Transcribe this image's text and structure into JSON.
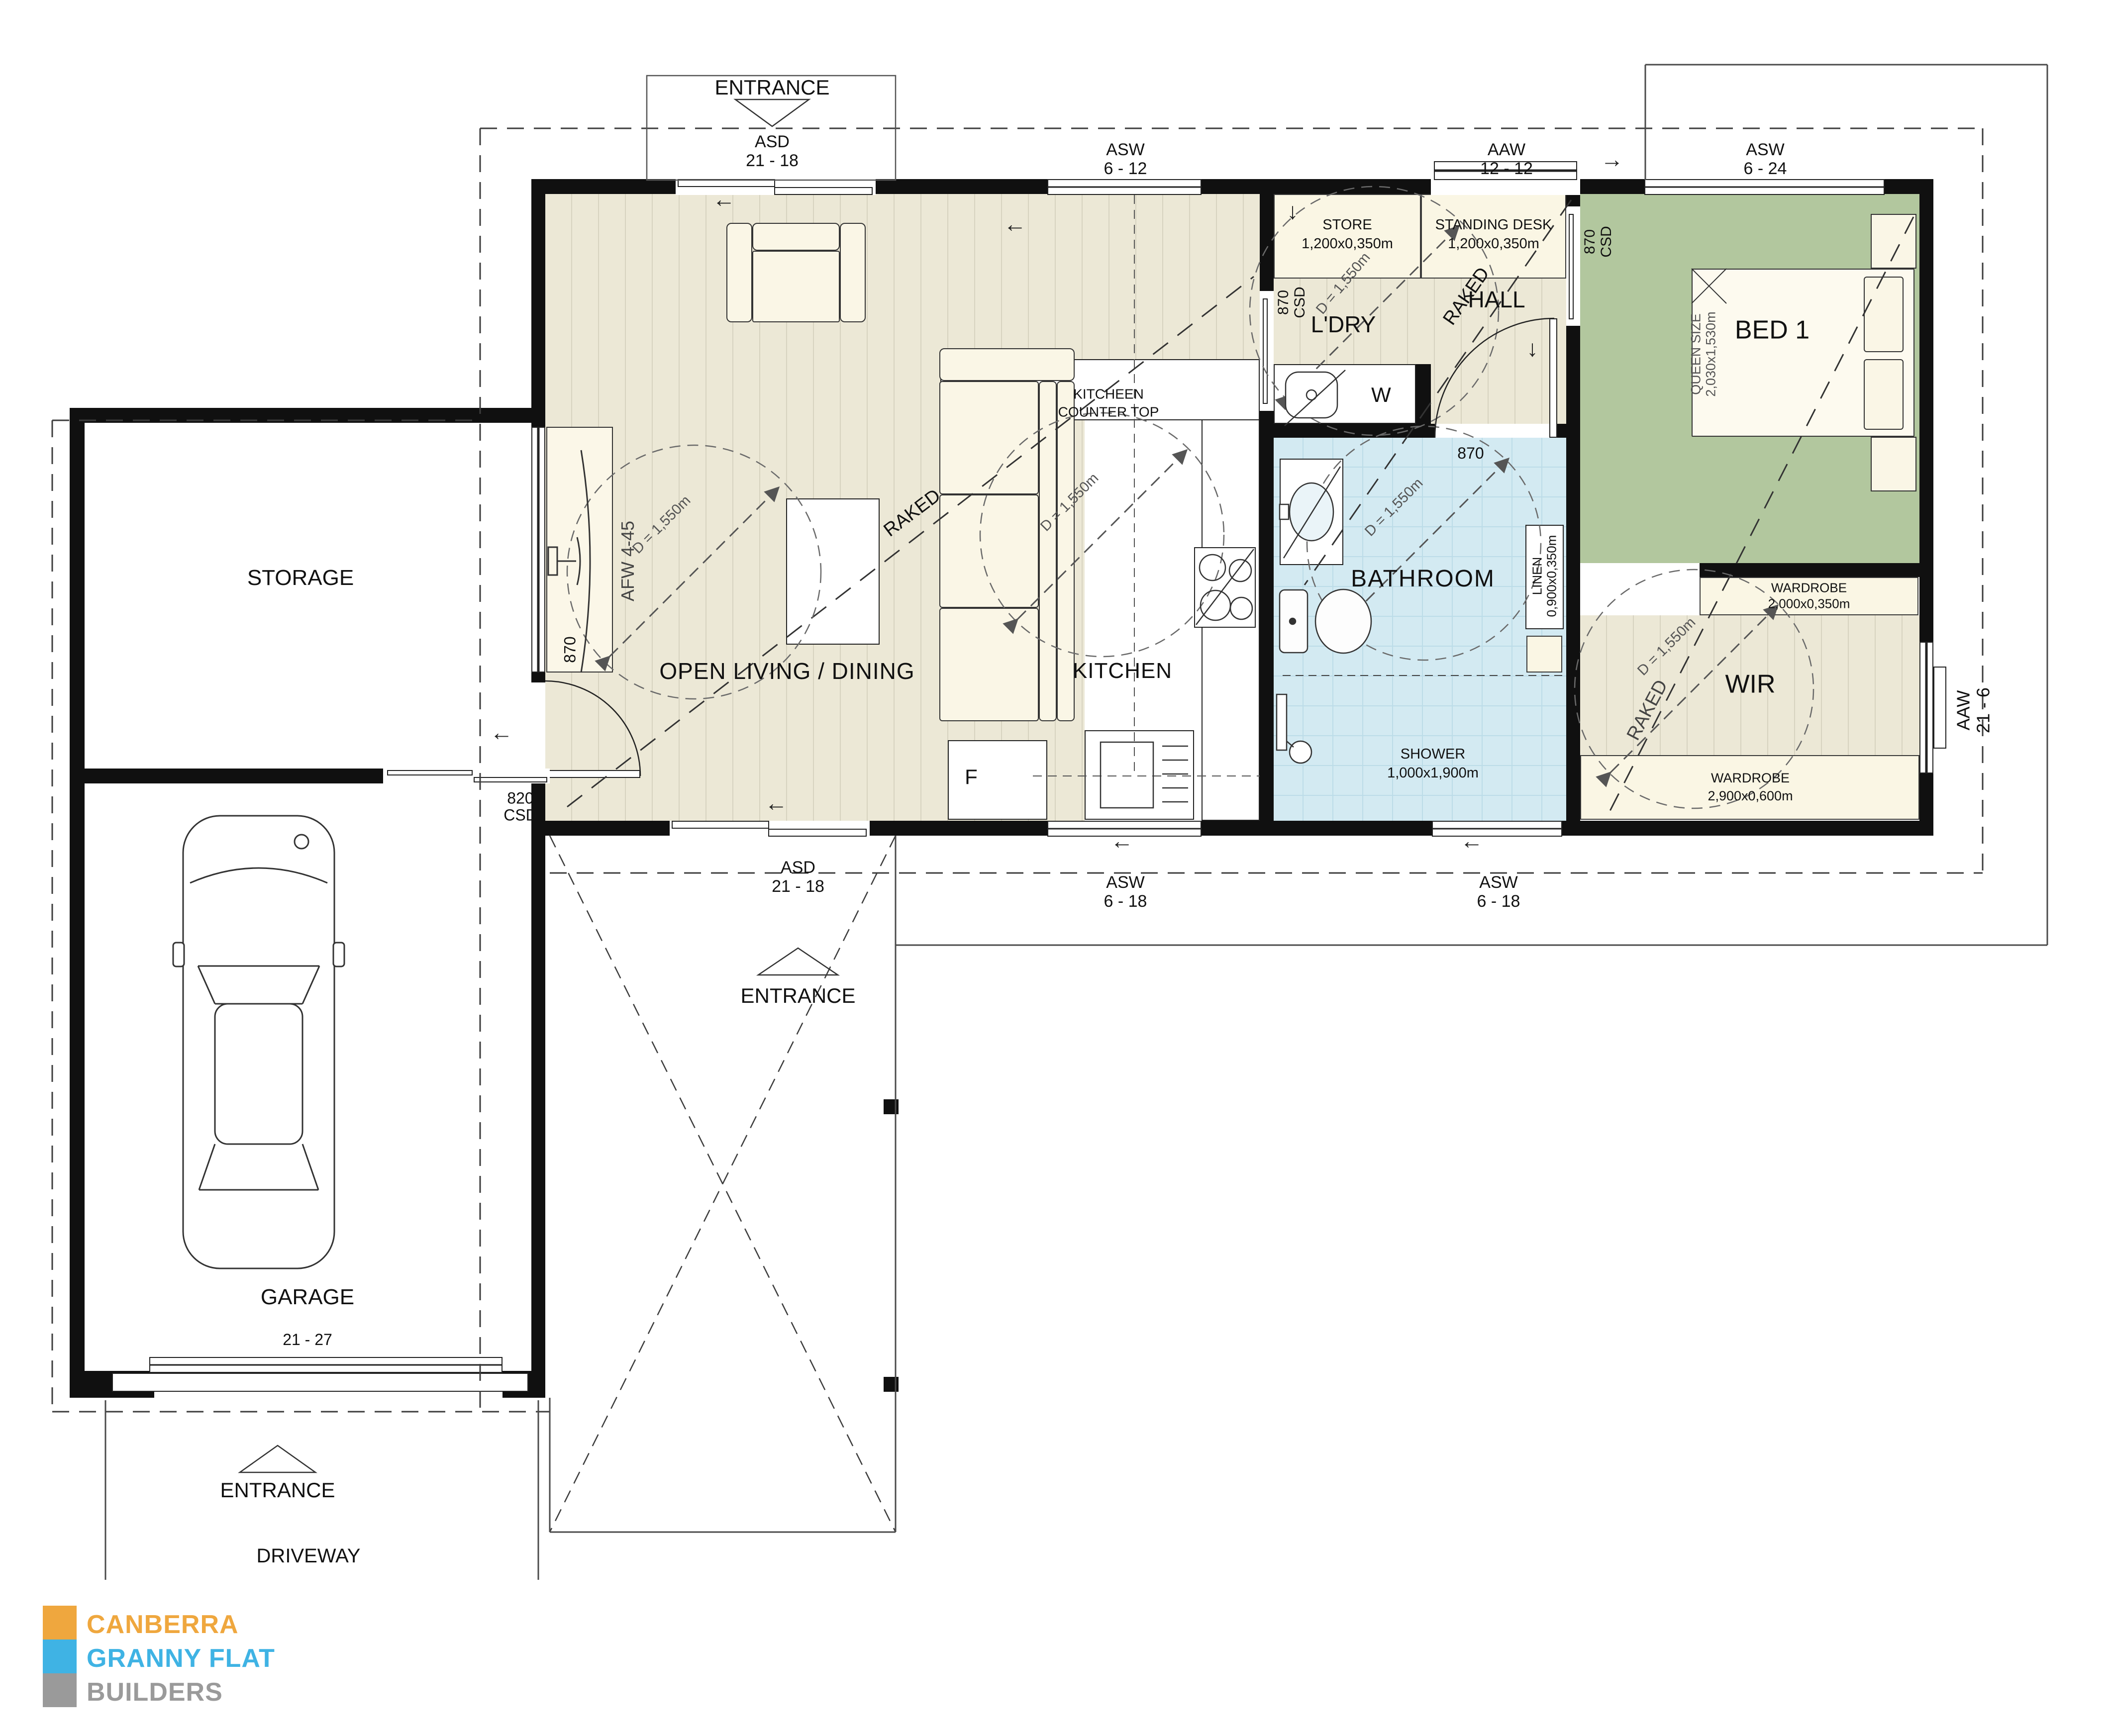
{
  "logo": {
    "line1": "CANBERRA",
    "line2": "GRANNY FLAT",
    "line3": "BUILDERS",
    "orange": "#EFA73E",
    "blue": "#3FB3E4",
    "gray": "#9A9A9A"
  },
  "rooms": {
    "storage": "STORAGE",
    "garage": "GARAGE",
    "living": "OPEN LIVING / DINING",
    "kitchen": "KITCHEN",
    "laundry": "L'DRY",
    "hall": "HALL",
    "bathroom": "BATHROOM",
    "bed1": "BED 1",
    "wir": "WIR",
    "driveway": "DRIVEWAY"
  },
  "site": {
    "entrance": "ENTRANCE",
    "garage_door_size": "21 - 27"
  },
  "openings": {
    "asd": {
      "code": "ASD",
      "size": "21 - 18"
    },
    "asw_6_12": {
      "code": "ASW",
      "size": "6 - 12"
    },
    "aaw_12_12": {
      "code": "AAW",
      "size": "12 - 12"
    },
    "asw_6_24": {
      "code": "ASW",
      "size": "6 - 24"
    },
    "asw_6_18": {
      "code": "ASW",
      "size": "6 - 18"
    },
    "aaw_21_6": {
      "code": "AAW",
      "size": "21 - 6"
    },
    "afw": "AFW 4-45",
    "door_870": "870",
    "door_820": "820",
    "csd": "CSD"
  },
  "fixtures": {
    "counter_line1": "KITCHEEN",
    "counter_line2": "COUNTER TOP",
    "store": {
      "name": "STORE",
      "size": "1,200x0,350m"
    },
    "standing_desk": {
      "name": "STANDING DESK",
      "size": "1,200x0,350m"
    },
    "linen": {
      "name": "LINEN",
      "size": "0,900x0,350m"
    },
    "shower": {
      "name": "SHOWER",
      "size": "1,000x1,900m"
    },
    "wardrobe_top": {
      "name": "WARDROBE",
      "size": "2,000x0,350m"
    },
    "wardrobe_bottom": {
      "name": "WARDROBE",
      "size": "2,900x0,600m"
    },
    "queen_bed": {
      "name": "QUEEN SIZE",
      "size": "2,030x1,530m"
    },
    "washer": "W",
    "fridge": "F"
  },
  "annotations": {
    "diameter": "D = 1,550m",
    "raked": "RAKED"
  }
}
